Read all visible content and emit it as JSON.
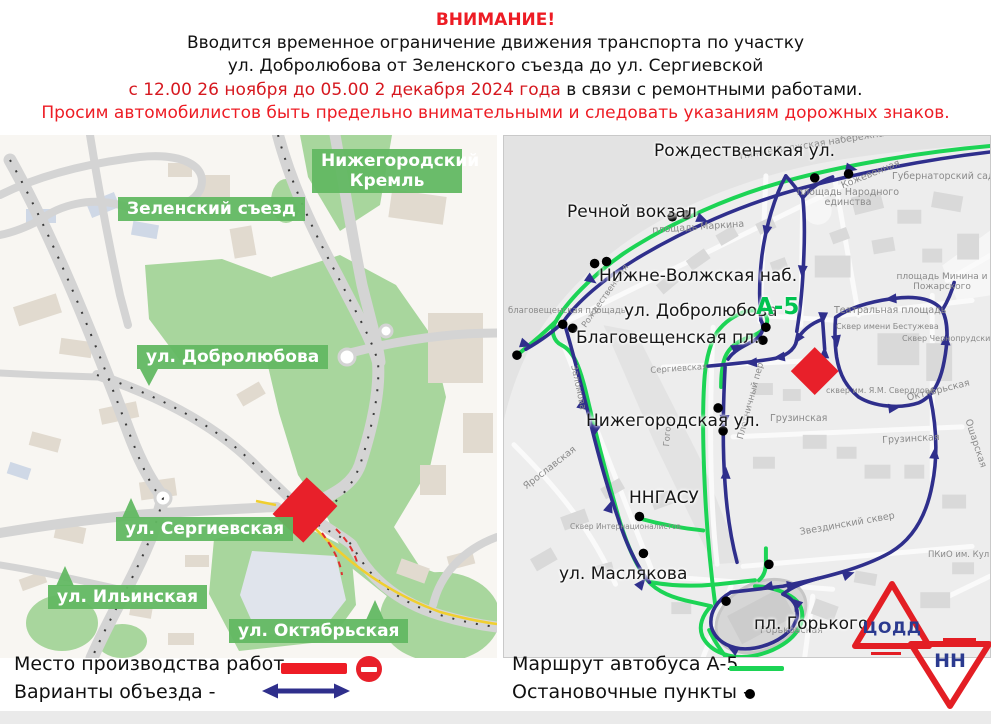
{
  "header": {
    "title": "ВНИМАНИЕ!",
    "line2": "Вводится временное ограничение движения транспорта по участку",
    "line3": "ул. Добролюбова от Зеленского съезда до ул. Сергиевской",
    "line4_red": "с 12.00 26 ноября до 05.00 2 декабря 2024 года",
    "line4_black": " в связи с ремонтными работами.",
    "line5": "Просим автомобилистов быть предельно внимательными и следовать указаниям дорожных знаков."
  },
  "colors": {
    "accent_red": "#ed1c24",
    "closure_red": "#e8202a",
    "route_green": "#1cd455",
    "detour_navy": "#2f2f8c",
    "label_green": "#62b862"
  },
  "left_map": {
    "labels": [
      {
        "text": "Нижегородский Кремль"
      },
      {
        "text": "Зеленский съезд"
      },
      {
        "text": "ул. Добролюбова"
      },
      {
        "text": "ул. Сергиевская"
      },
      {
        "text": "ул. Ильинская"
      },
      {
        "text": "ул. Октябрьская"
      }
    ]
  },
  "right_map": {
    "route_badge": "А-5",
    "labels": [
      {
        "text": "Рождественская ул."
      },
      {
        "text": "Речной вокзал"
      },
      {
        "text": "Нижне-Волжская наб."
      },
      {
        "text": "ул. Добролюбова"
      },
      {
        "text": "Благовещенская пл."
      },
      {
        "text": "Нижегородская ул."
      },
      {
        "text": "ННГАСУ"
      },
      {
        "text": "ул. Маслякова"
      },
      {
        "text": "пл. Горького"
      }
    ],
    "minor_labels": [
      {
        "text": "Нижне-Волжская набережная"
      },
      {
        "text": "Кожевенная"
      },
      {
        "text": "Губернаторский сад"
      },
      {
        "text": "площадь Народного единства"
      },
      {
        "text": "площадь Маркина"
      },
      {
        "text": "площадь Минина и Пожарского"
      },
      {
        "text": "благовещенская площадь"
      },
      {
        "text": "Театральная площадь"
      },
      {
        "text": "Сквер имени Бестужева"
      },
      {
        "text": "Сквер Чернопрудский"
      },
      {
        "text": "сквер им. Я.М. Свердлова"
      },
      {
        "text": "Грузинская"
      },
      {
        "text": "Грузинская"
      },
      {
        "text": "Октябрьская"
      },
      {
        "text": "Ошарская"
      },
      {
        "text": "Ярославская"
      },
      {
        "text": "Сквер Интернационалистов"
      },
      {
        "text": "Звездинский сквер"
      },
      {
        "text": "Горьковская"
      },
      {
        "text": "ПКиО им. Кул"
      },
      {
        "text": "Плотничный пер"
      },
      {
        "text": "Заломова"
      },
      {
        "text": "Сергиевская"
      },
      {
        "text": "Рождественская"
      },
      {
        "text": "Гоголя"
      }
    ]
  },
  "legend": {
    "work_site": "Место производства работ -",
    "detours": "Варианты объезда -",
    "bus_route": "Маршрут автобуса  А-5",
    "stops": "Остановочные пункты -"
  },
  "logo": {
    "line1": "ЦОДД",
    "line2": "НН"
  }
}
